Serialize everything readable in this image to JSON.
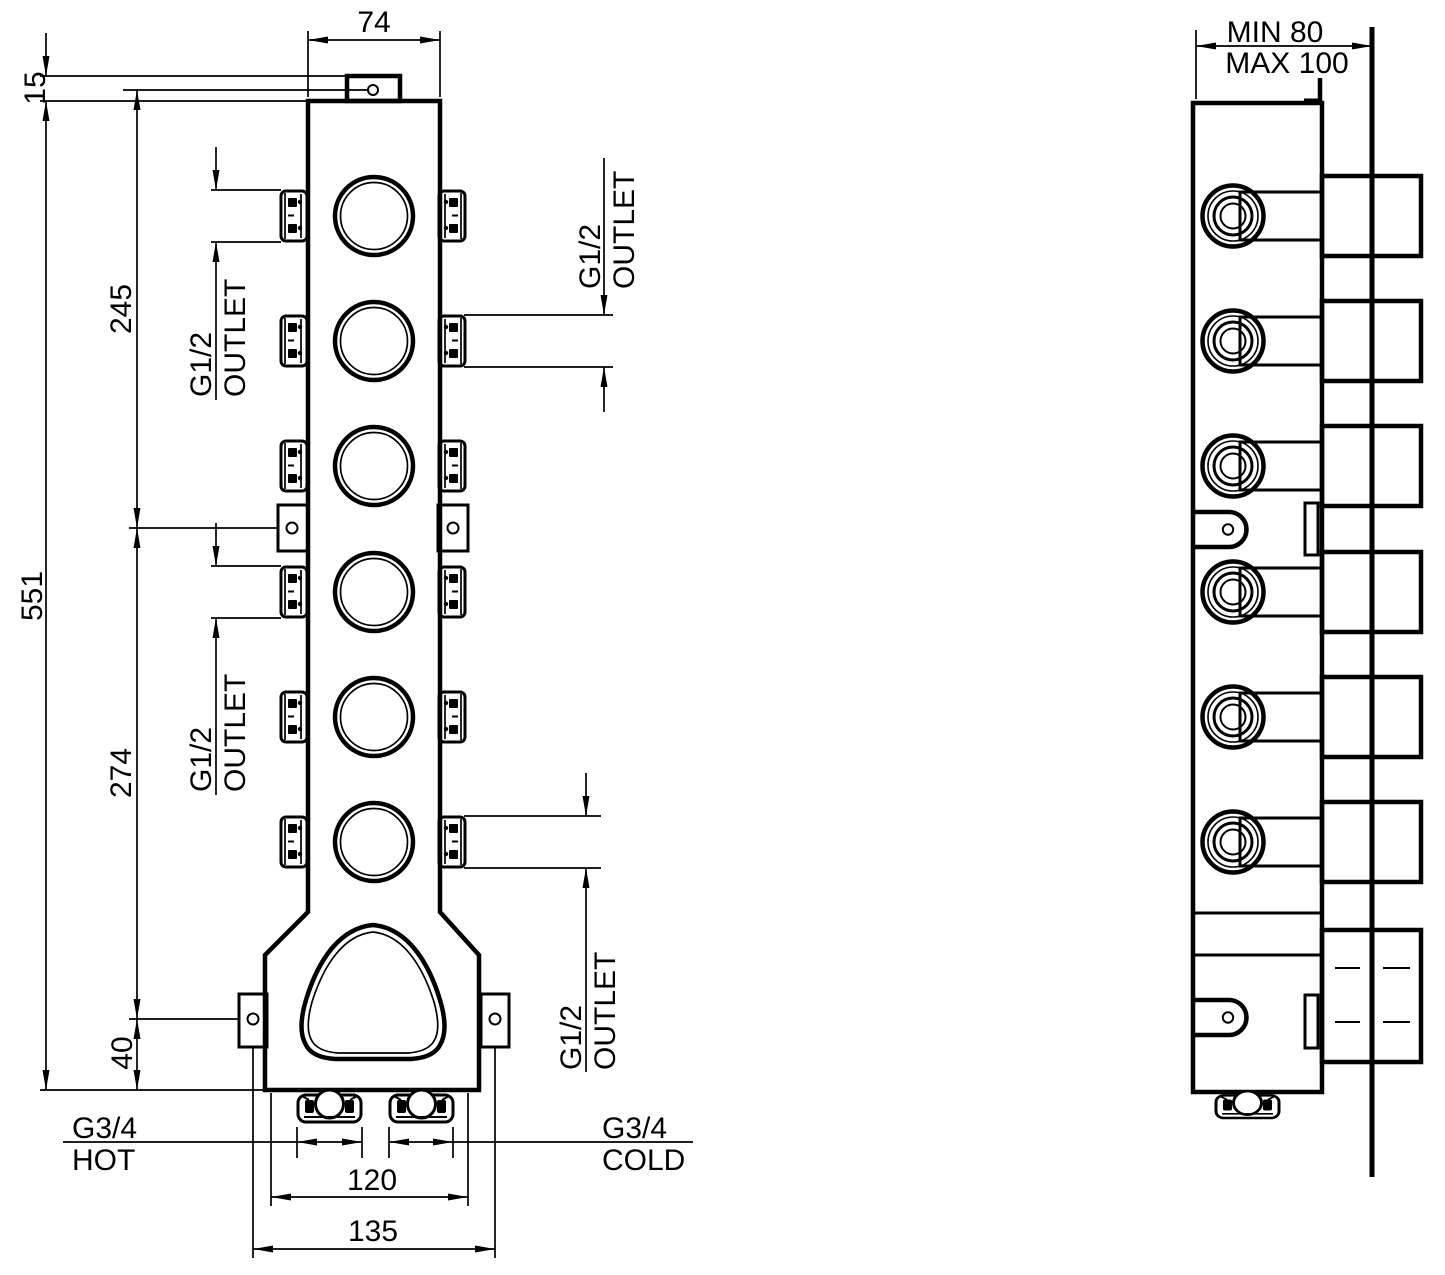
{
  "front_view": {
    "dims": {
      "top_width": "74",
      "tab_offset": "15",
      "upper_span": "245",
      "overall_height": "551",
      "mid_span": "274",
      "base_span": "40",
      "inlet_span": "120",
      "mount_span": "135"
    },
    "outlet_callout": {
      "size": "G1/2",
      "word": "OUTLET"
    },
    "hot_inlet": {
      "size": "G3/4",
      "word": "HOT"
    },
    "cold_inlet": {
      "size": "G3/4",
      "word": "COLD"
    }
  },
  "side_view": {
    "depth_min": "MIN 80",
    "depth_max": "MAX 100"
  },
  "colors": {
    "line": "#000000",
    "background": "#ffffff"
  }
}
